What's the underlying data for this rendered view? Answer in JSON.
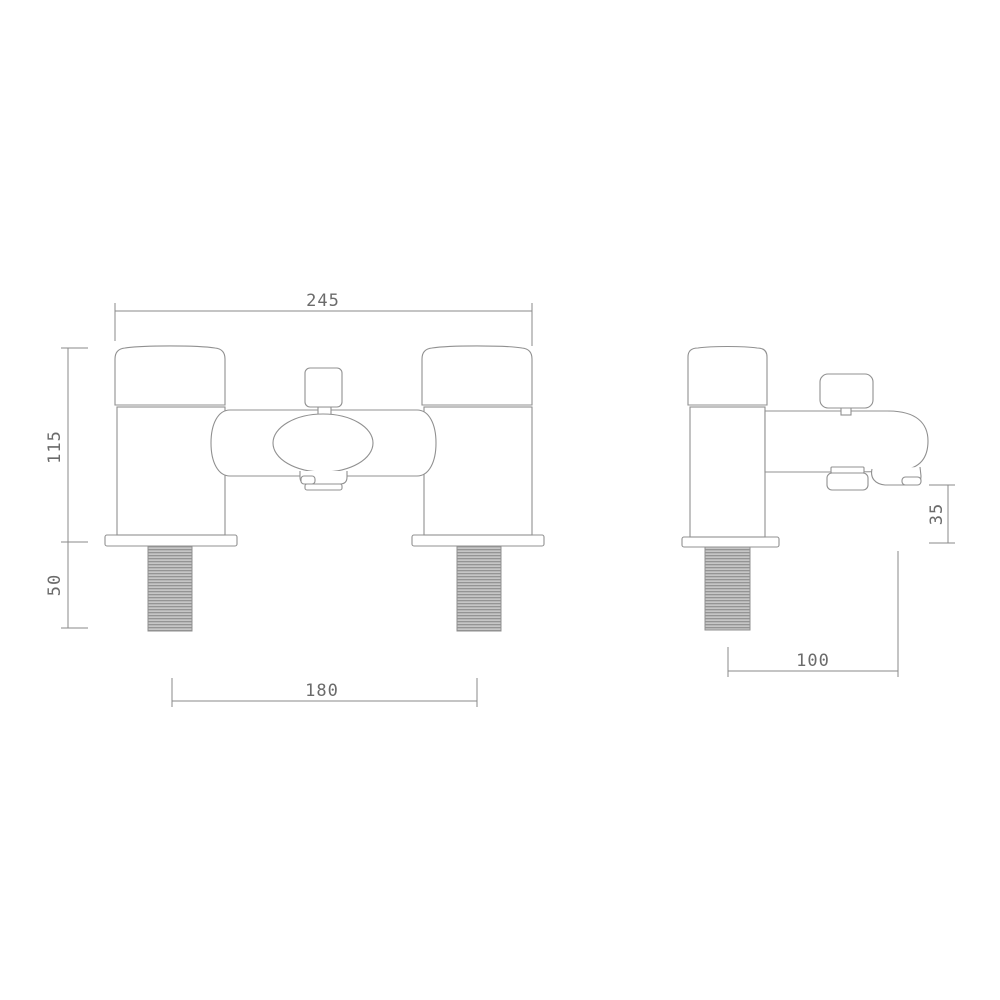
{
  "dims": {
    "front_overall_width": "245",
    "front_body_height": "115",
    "front_thread_length": "50",
    "front_inlet_centres": "180",
    "side_spout_height": "35",
    "side_spout_reach": "100"
  },
  "colors": {
    "background": "#ffffff",
    "outline": "#909090",
    "dimension_line": "#8a8a8a",
    "label_text": "#6b6b6b",
    "thread_dark": "#949494",
    "thread_light": "#c6c6c6"
  }
}
